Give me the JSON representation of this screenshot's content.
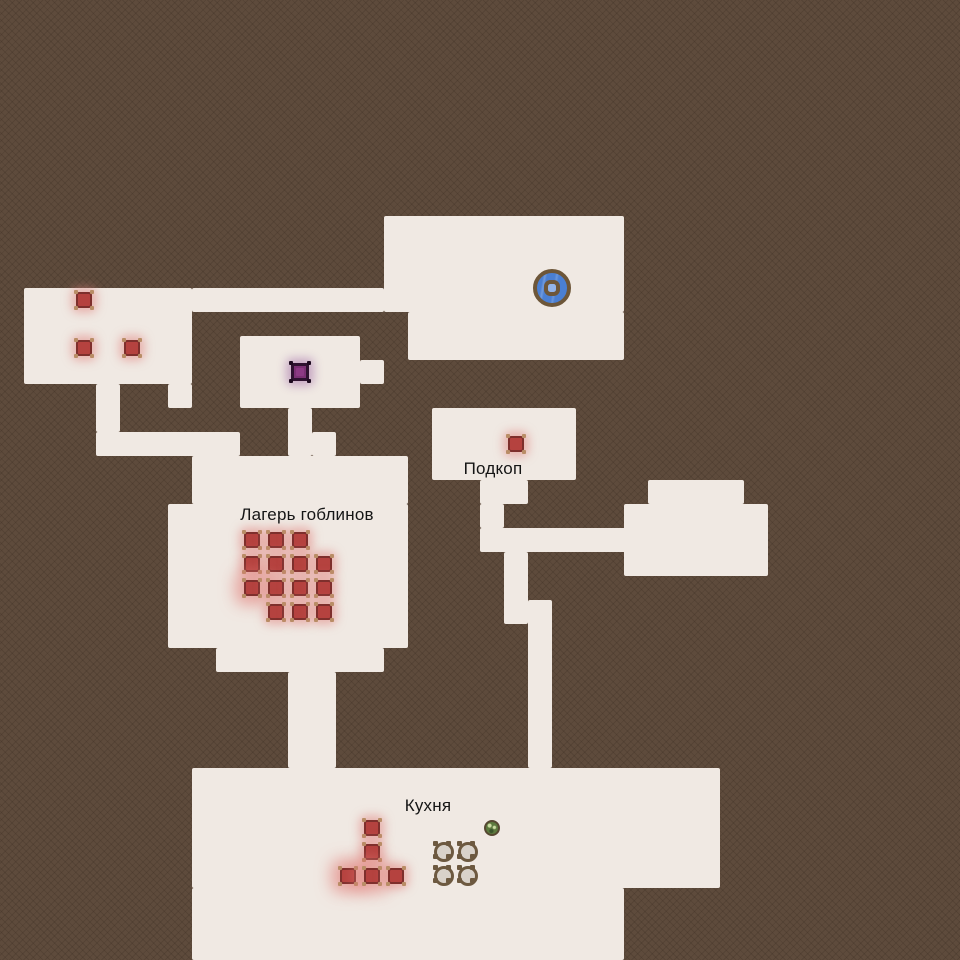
{
  "map": {
    "colors": {
      "background": "#5e4b3c",
      "floor": "#f0e9e3",
      "enemy_red": "#b5423f",
      "enemy_purple": "#7c3174",
      "well_blue": "#4a7fd3",
      "ring_brown": "#6d5639",
      "pot_fill": "#d9d2ca",
      "bush_green": "#5d7a3e",
      "label_text": "#151515"
    },
    "rooms": [
      {
        "name": "room-top-left",
        "x": 24,
        "y": 288,
        "w": 168,
        "h": 96
      },
      {
        "name": "corridor-top",
        "x": 192,
        "y": 288,
        "w": 192,
        "h": 24
      },
      {
        "name": "well-room-upper",
        "x": 384,
        "y": 216,
        "w": 240,
        "h": 96
      },
      {
        "name": "well-room-lower",
        "x": 408,
        "y": 312,
        "w": 216,
        "h": 48
      },
      {
        "name": "room-top-left-stub",
        "x": 168,
        "y": 384,
        "w": 24,
        "h": 24
      },
      {
        "name": "corridor-left-vertical",
        "x": 96,
        "y": 384,
        "w": 24,
        "h": 48
      },
      {
        "name": "corridor-left-horizontal",
        "x": 96,
        "y": 432,
        "w": 144,
        "h": 24
      },
      {
        "name": "room-purple",
        "x": 240,
        "y": 336,
        "w": 120,
        "h": 72
      },
      {
        "name": "room-purple-tab",
        "x": 360,
        "y": 360,
        "w": 24,
        "h": 24
      },
      {
        "name": "corridor-purple-camp",
        "x": 288,
        "y": 408,
        "w": 24,
        "h": 48
      },
      {
        "name": "camp-step",
        "x": 312,
        "y": 432,
        "w": 24,
        "h": 24
      },
      {
        "name": "camp-top-band",
        "x": 192,
        "y": 456,
        "w": 216,
        "h": 48
      },
      {
        "name": "camp-main",
        "x": 168,
        "y": 504,
        "w": 240,
        "h": 144
      },
      {
        "name": "camp-bottom-lip",
        "x": 216,
        "y": 648,
        "w": 168,
        "h": 24
      },
      {
        "name": "corridor-camp-kitchen",
        "x": 288,
        "y": 672,
        "w": 48,
        "h": 96
      },
      {
        "name": "room-podkop",
        "x": 432,
        "y": 408,
        "w": 144,
        "h": 72
      },
      {
        "name": "corridor-podkop-down-a",
        "x": 480,
        "y": 480,
        "w": 48,
        "h": 24
      },
      {
        "name": "corridor-podkop-down-b",
        "x": 480,
        "y": 504,
        "w": 24,
        "h": 24
      },
      {
        "name": "corridor-podkop-horizontal",
        "x": 480,
        "y": 528,
        "w": 168,
        "h": 24
      },
      {
        "name": "room-east-top",
        "x": 648,
        "y": 480,
        "w": 96,
        "h": 24
      },
      {
        "name": "room-east-main",
        "x": 624,
        "y": 504,
        "w": 144,
        "h": 72
      },
      {
        "name": "corridor-east-down-a",
        "x": 504,
        "y": 552,
        "w": 24,
        "h": 72
      },
      {
        "name": "corridor-east-down-b",
        "x": 528,
        "y": 600,
        "w": 24,
        "h": 168
      },
      {
        "name": "kitchen-main",
        "x": 192,
        "y": 768,
        "w": 528,
        "h": 120
      },
      {
        "name": "kitchen-lower",
        "x": 192,
        "y": 888,
        "w": 432,
        "h": 72
      }
    ],
    "labels": [
      {
        "name": "label-goblin-camp",
        "text": "Лагерь гоблинов",
        "x": 307,
        "y": 515
      },
      {
        "name": "label-podkop",
        "text": "Подкоп",
        "x": 493,
        "y": 469
      },
      {
        "name": "label-kitchen",
        "text": "Кухня",
        "x": 428,
        "y": 806
      }
    ],
    "enemies_red": [
      {
        "x": 84,
        "y": 300
      },
      {
        "x": 84,
        "y": 348
      },
      {
        "x": 132,
        "y": 348
      },
      {
        "x": 516,
        "y": 444
      },
      {
        "x": 252,
        "y": 540
      },
      {
        "x": 276,
        "y": 540
      },
      {
        "x": 300,
        "y": 540
      },
      {
        "x": 252,
        "y": 564
      },
      {
        "x": 276,
        "y": 564
      },
      {
        "x": 300,
        "y": 564
      },
      {
        "x": 324,
        "y": 564
      },
      {
        "x": 252,
        "y": 588,
        "strong": true
      },
      {
        "x": 276,
        "y": 588
      },
      {
        "x": 300,
        "y": 588
      },
      {
        "x": 324,
        "y": 588
      },
      {
        "x": 276,
        "y": 612
      },
      {
        "x": 300,
        "y": 612
      },
      {
        "x": 324,
        "y": 612
      },
      {
        "x": 372,
        "y": 828
      },
      {
        "x": 372,
        "y": 852
      },
      {
        "x": 348,
        "y": 876,
        "strong": true
      },
      {
        "x": 372,
        "y": 876,
        "strong": true
      },
      {
        "x": 396,
        "y": 876
      }
    ],
    "enemies_purple": [
      {
        "x": 300,
        "y": 372
      }
    ],
    "wells": [
      {
        "x": 552,
        "y": 288
      }
    ],
    "plants": [
      {
        "x": 492,
        "y": 828
      }
    ],
    "pots": [
      {
        "x": 444,
        "y": 852
      },
      {
        "x": 468,
        "y": 852
      },
      {
        "x": 444,
        "y": 876
      },
      {
        "x": 468,
        "y": 876
      }
    ]
  }
}
